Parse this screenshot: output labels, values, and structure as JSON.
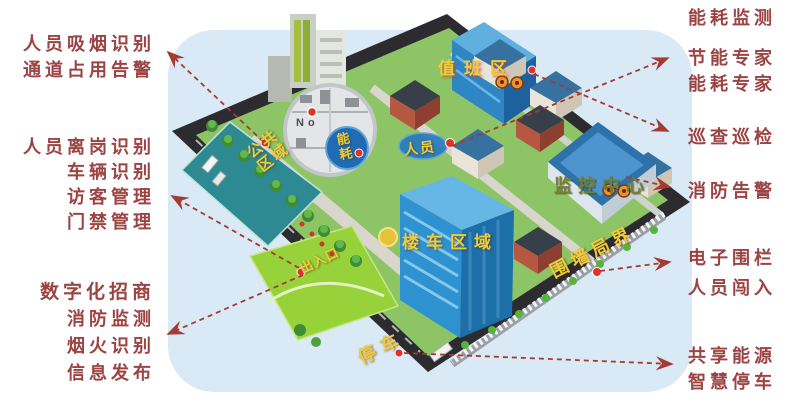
{
  "side_labels": {
    "left_groups": [
      {
        "lines": [
          "人员吸烟识别",
          "通道占用告警"
        ]
      },
      {
        "lines": [
          "人员离岗识别",
          "车辆识别",
          "访客管理",
          "门禁管理"
        ]
      },
      {
        "lines": [
          "数字化招商",
          "消防监测",
          "烟火识别",
          "信息发布"
        ]
      }
    ],
    "right_groups": [
      {
        "lines": [
          "能耗监测"
        ]
      },
      {
        "lines": [
          "节能专家",
          "能耗专家"
        ]
      },
      {
        "lines": [
          "巡查巡检"
        ]
      },
      {
        "lines": [
          "消防告警"
        ]
      },
      {
        "lines": [
          "电子围栏",
          "人员闯入"
        ]
      },
      {
        "lines": [
          "共享能源",
          "智慧停车"
        ]
      }
    ]
  },
  "map_labels": {
    "duty_area": "值班区",
    "personnel": "人员",
    "energy": "能耗",
    "public_area": "公共区域",
    "monitoring_center": "监控中心",
    "building_vehicle_area": "楼车区域",
    "entrance_exit": "出入口",
    "wall_boundary": "围墙局界",
    "parking": "停车",
    "magnifier_text": "No"
  },
  "icons": {
    "magnifier_inset": "magnifier-zoom-circle-icon",
    "energy_badge": "energy-circle-badge-icon",
    "personnel_badge": "personnel-ellipse-badge-icon",
    "alarm_badge": "alarm-badge-icon",
    "point_marker": "red-dot-marker",
    "area_marker": "yellow-dot-marker",
    "arrow": "dashed-arrow"
  },
  "colors": {
    "annotation_text": "#9c4343",
    "arrow": "#a63a32",
    "map_label_yellow": "#f2cc38",
    "monitor_label_olive": "#77802e",
    "map_background": "#d9e9f6",
    "platform_dark": "#2b2b30",
    "lawn_green": "#8cc466",
    "field_green": "#97d23b",
    "public_area_teal": "#2d8a92",
    "building_blue": "#2f92d0",
    "page_background": "#ffffff"
  }
}
